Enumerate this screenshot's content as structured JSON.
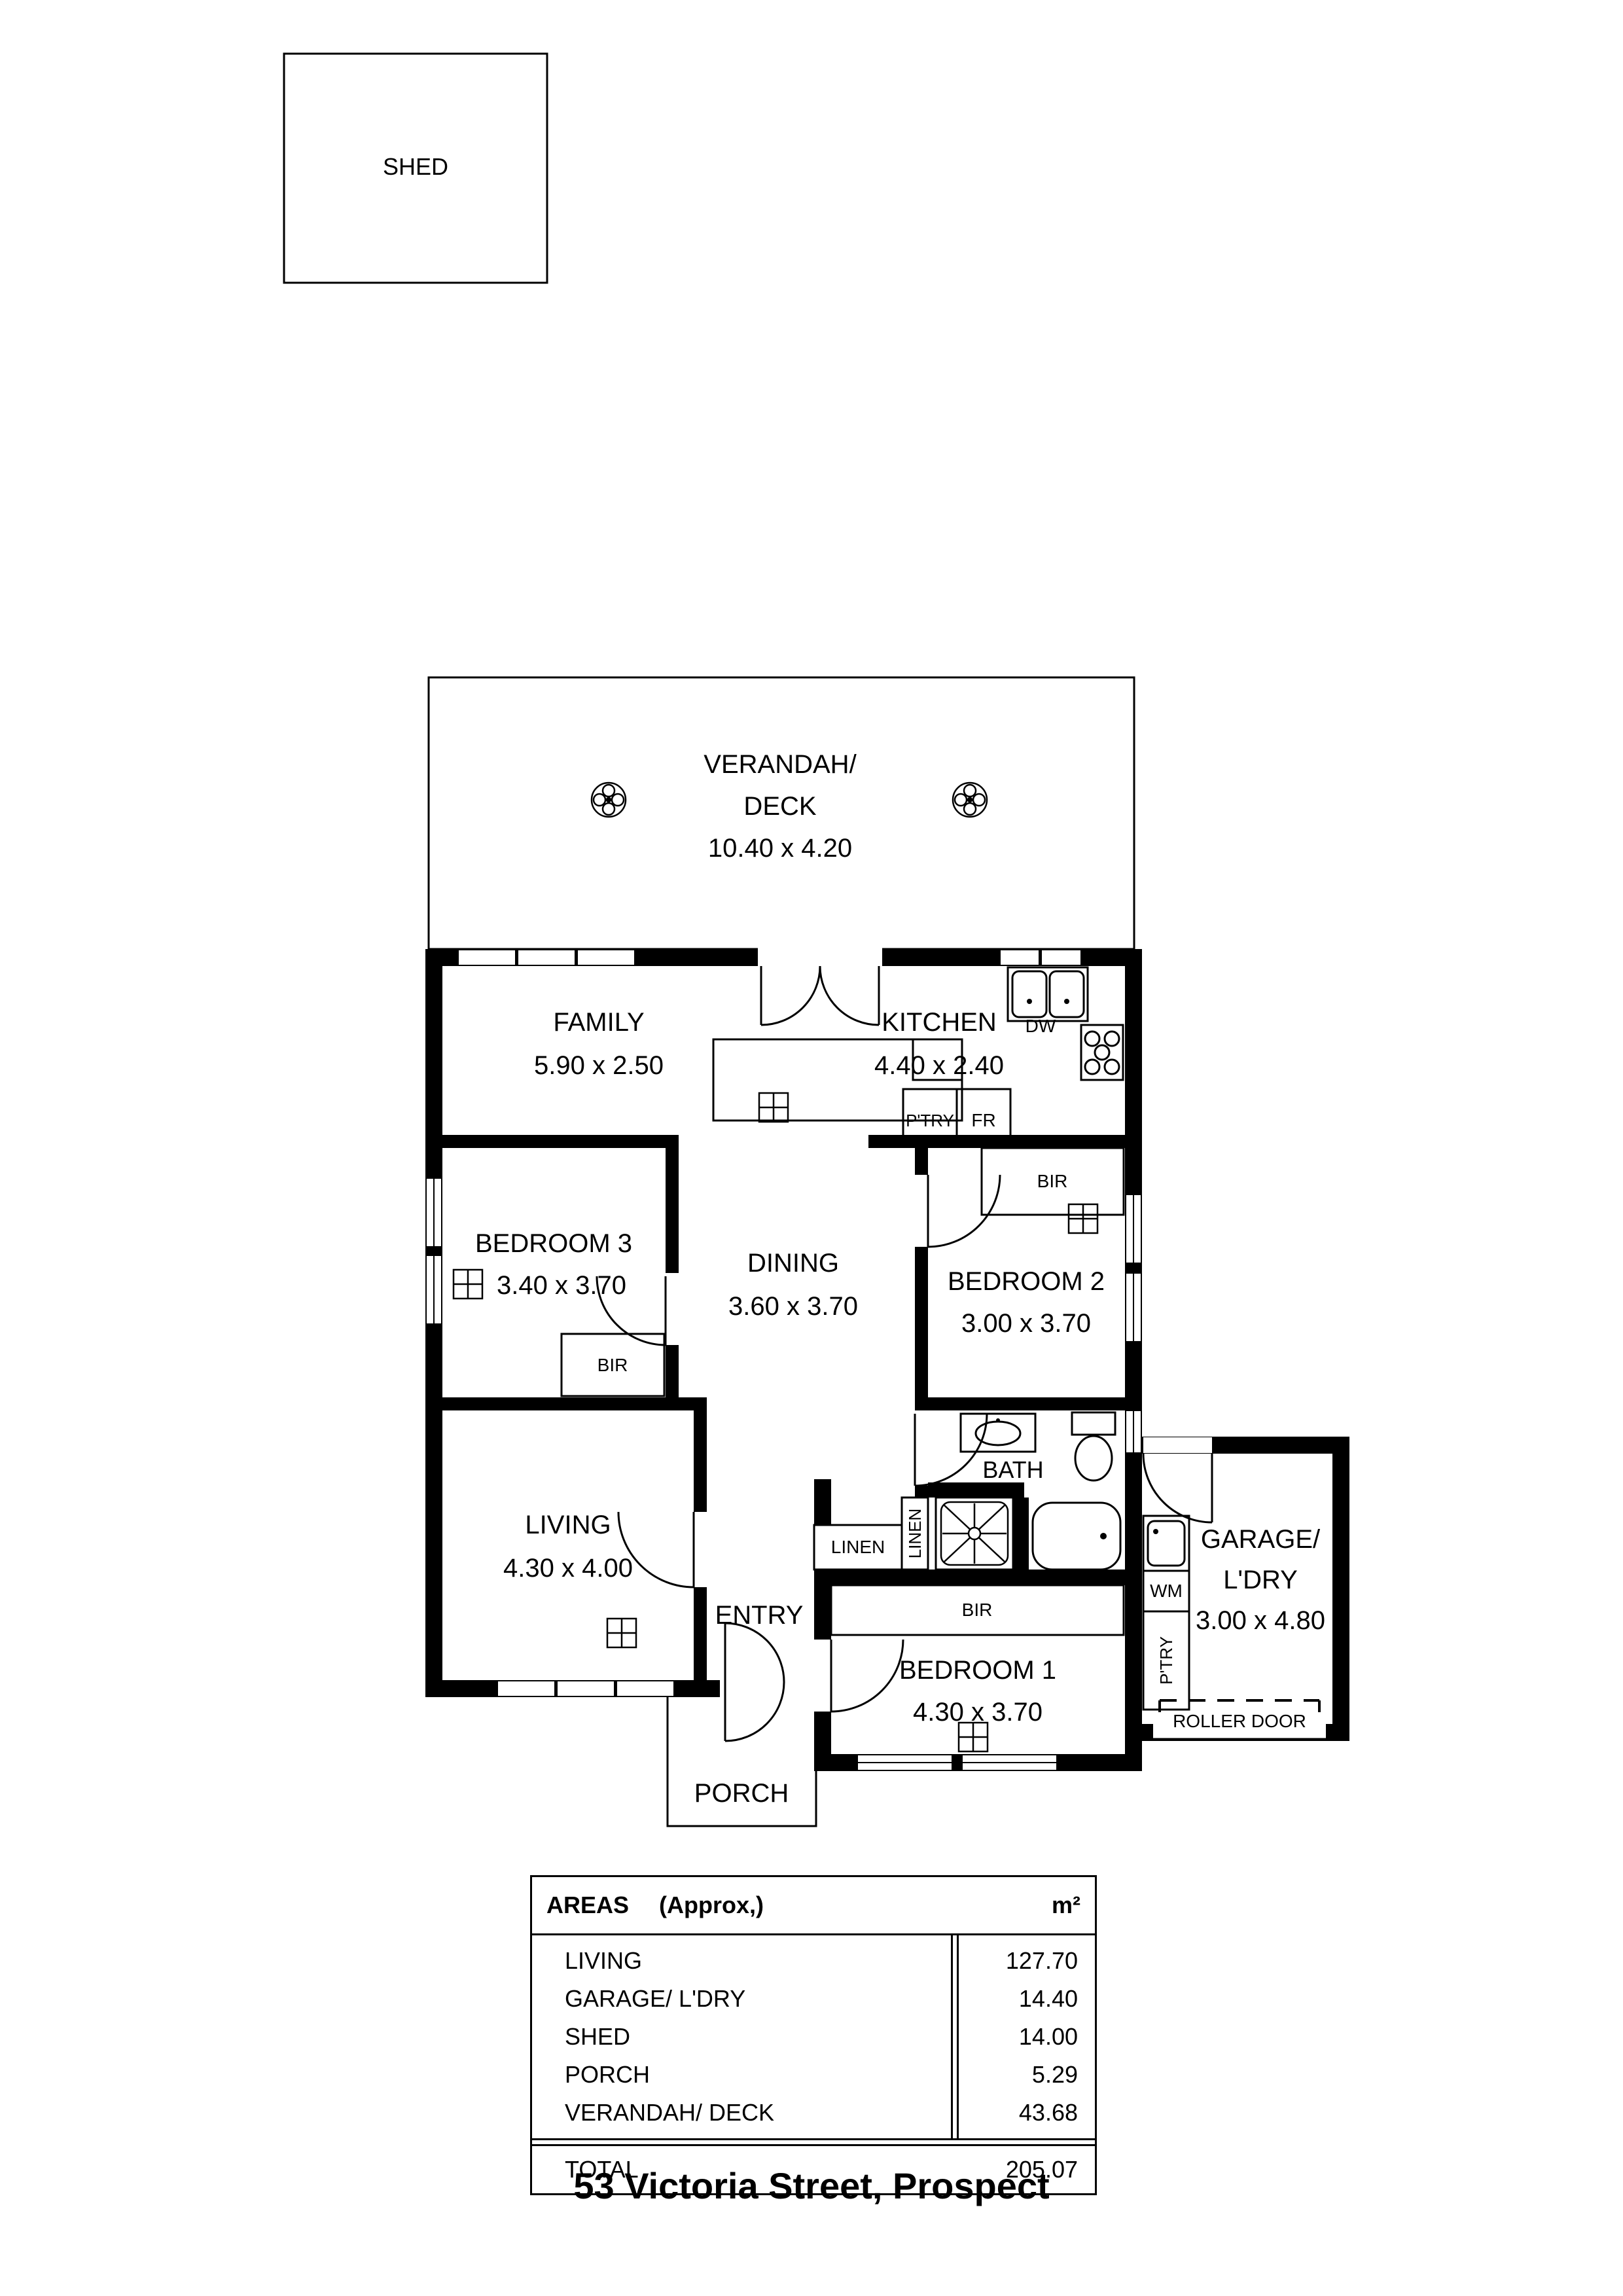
{
  "title": "53 Victoria Street, Prospect",
  "shed": {
    "label": "SHED"
  },
  "verandah": {
    "line1": "VERANDAH/",
    "line2": "DECK",
    "dims": "10.40 x 4.20"
  },
  "rooms": {
    "family": {
      "name": "FAMILY",
      "dims": "5.90 x 2.50"
    },
    "kitchen": {
      "name": "KITCHEN",
      "dims": "4.40 x 2.40"
    },
    "bedroom3": {
      "name": "BEDROOM 3",
      "dims": "3.40 x 3.70"
    },
    "dining": {
      "name": "DINING",
      "dims": "3.60 x 3.70"
    },
    "bedroom2": {
      "name": "BEDROOM 2",
      "dims": "3.00 x 3.70"
    },
    "living": {
      "name": "LIVING",
      "dims": "4.30 x 4.00"
    },
    "entry": {
      "name": "ENTRY"
    },
    "bath": {
      "name": "BATH"
    },
    "bedroom1": {
      "name": "BEDROOM 1",
      "dims": "4.30 x 3.70"
    },
    "garage": {
      "line1": "GARAGE/",
      "line2": "L'DRY",
      "dims": "3.00 x 4.80"
    },
    "porch": {
      "name": "PORCH"
    }
  },
  "fixtures": {
    "dw": "DW",
    "fr": "FR",
    "ptry": "P'TRY",
    "bir": "BIR",
    "linen": "LINEN",
    "wm": "WM",
    "roller_door": "ROLLER DOOR"
  },
  "areas_table": {
    "header": {
      "title": "AREAS",
      "approx": "(Approx,)",
      "unit": "m²"
    },
    "rows": [
      {
        "label": "LIVING",
        "value": "127.70"
      },
      {
        "label": "GARAGE/ L'DRY",
        "value": "14.40"
      },
      {
        "label": "SHED",
        "value": "14.00"
      },
      {
        "label": "PORCH",
        "value": "5.29"
      },
      {
        "label": "VERANDAH/ DECK",
        "value": "43.68"
      }
    ],
    "total": {
      "label": "TOTAL",
      "value": "205.07"
    }
  },
  "colors": {
    "wall": "#000000",
    "background": "#ffffff"
  }
}
